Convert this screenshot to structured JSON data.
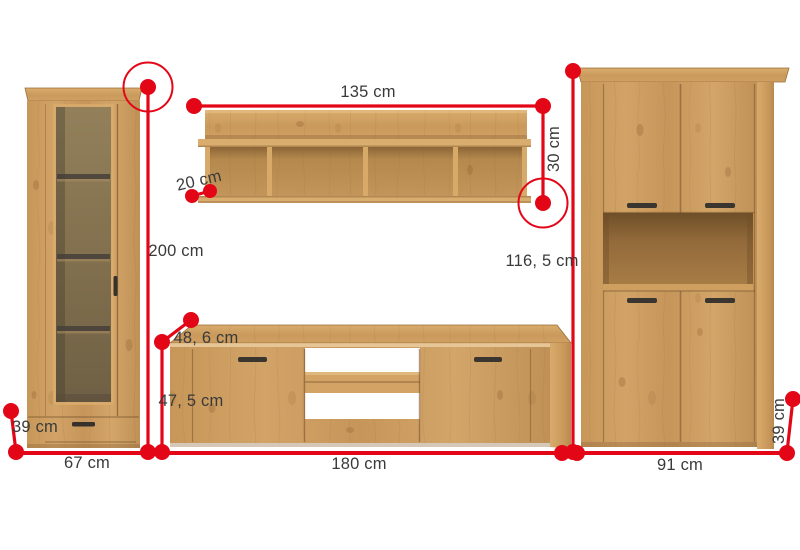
{
  "diagram": {
    "type": "furniture-dimension-diagram",
    "colors": {
      "accent_red": "#e30617",
      "label_text": "#3a3a3a",
      "wood_base": "#cd9d61",
      "wood_light": "#dcb173",
      "wood_dark_edge": "#8a5f33",
      "background": "#ffffff"
    }
  },
  "pieces": {
    "vitrine": {
      "name": "tall-display-cabinet",
      "height_label": "200 cm",
      "width_label": "67 cm",
      "depth_label": "39 cm"
    },
    "wall_shelf": {
      "name": "wall-shelf",
      "width_label": "135 cm",
      "height_label": "30 cm",
      "depth_label": "20 cm"
    },
    "tv_stand": {
      "name": "tv-stand",
      "width_label": "180 cm",
      "height_label": "47, 5 cm",
      "depth_label": "48, 6 cm"
    },
    "highboard": {
      "name": "highboard-cabinet",
      "width_label": "91 cm",
      "height_label": "116, 5 cm",
      "depth_label": "39 cm"
    }
  }
}
